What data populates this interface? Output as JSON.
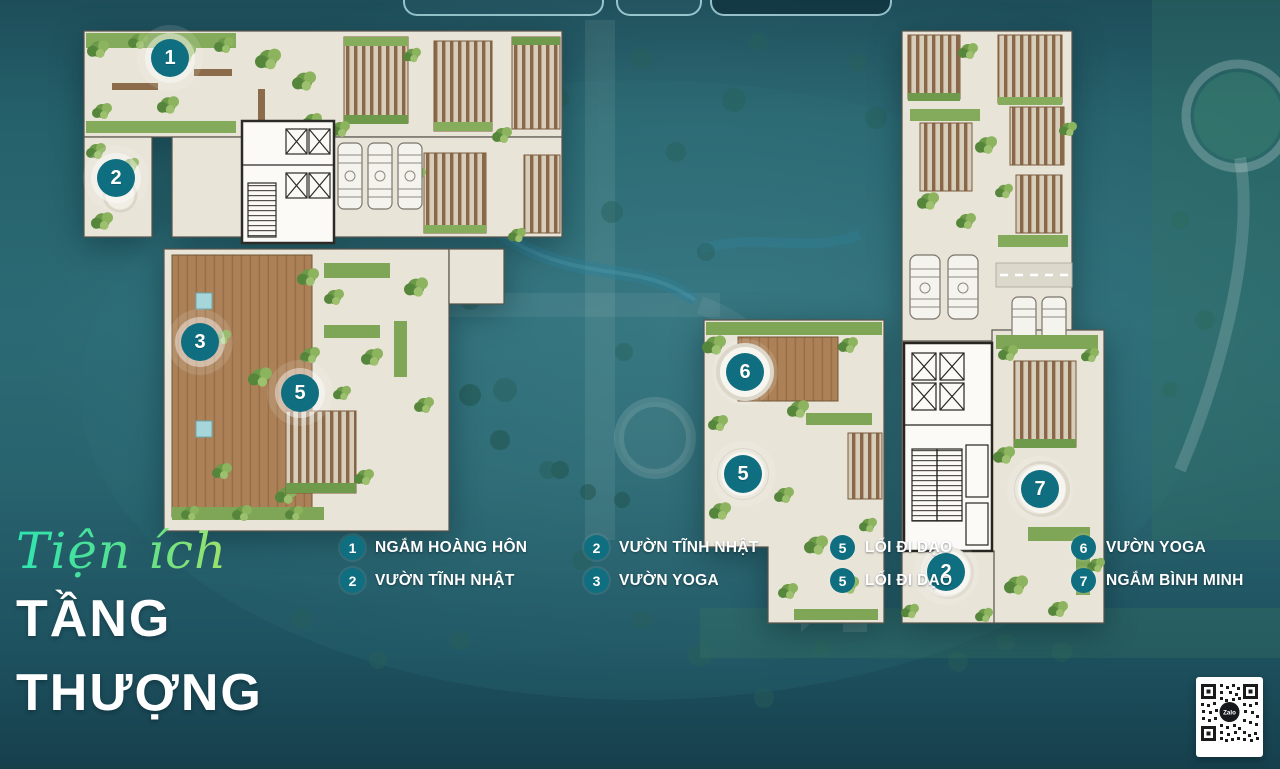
{
  "title": {
    "script": "Tiện ích",
    "line1": "TẦNG",
    "line2": "THƯỢNG"
  },
  "legend": {
    "groups": [
      {
        "items": [
          {
            "num": "1",
            "label": "NGẮM HOÀNG HÔN"
          },
          {
            "num": "2",
            "label": "VƯỜN TĨNH NHẬT"
          }
        ]
      },
      {
        "items": [
          {
            "num": "2",
            "label": "VƯỜN TĨNH NHẬT"
          },
          {
            "num": "3",
            "label": "VƯỜN YOGA"
          }
        ]
      },
      {
        "items": [
          {
            "num": "5",
            "label": "LỐI ĐI DẠO"
          },
          {
            "num": "5",
            "label": "LỐI ĐI DẠO"
          }
        ]
      },
      {
        "items": [
          {
            "num": "6",
            "label": "VƯỜN YOGA"
          },
          {
            "num": "7",
            "label": "NGẮM BÌNH MINH"
          }
        ]
      }
    ]
  },
  "markers": {
    "a": [
      {
        "num": "1"
      },
      {
        "num": "2"
      },
      {
        "num": "3"
      },
      {
        "num": "5"
      }
    ],
    "b": [
      {
        "num": "6"
      },
      {
        "num": "5"
      },
      {
        "num": "7"
      },
      {
        "num": "2"
      }
    ]
  },
  "qr": {
    "label": "Zalo"
  },
  "colors": {
    "accent_teal": "#0f6f80",
    "background_teal": "#2b6a74",
    "title_gradient_start": "#2fe4b0",
    "title_gradient_end": "#b9e35e"
  }
}
